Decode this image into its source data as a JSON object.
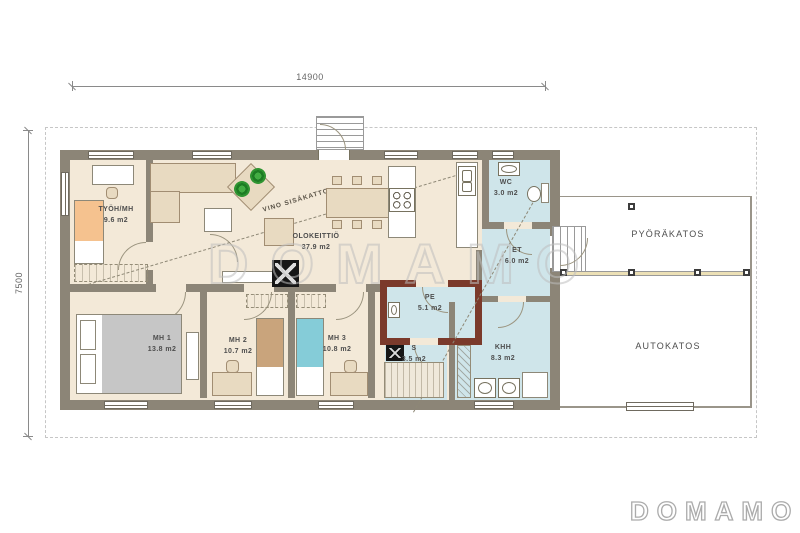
{
  "dimensions": {
    "width": "14900",
    "height": "7500"
  },
  "rooms": {
    "tyoh": {
      "name": "TYÖH/MH",
      "area": "9.6 m2"
    },
    "olokeittio": {
      "name": "OLOKEITTIÖ",
      "area": "37.9 m2"
    },
    "mh1": {
      "name": "MH 1",
      "area": "13.8 m2"
    },
    "mh2": {
      "name": "MH 2",
      "area": "10.7 m2"
    },
    "mh3": {
      "name": "MH 3",
      "area": "10.8 m2"
    },
    "wc": {
      "name": "WC",
      "area": "3.0 m2"
    },
    "et": {
      "name": "ET",
      "area": "6.0 m2"
    },
    "pe": {
      "name": "PE",
      "area": "5.1 m2"
    },
    "s": {
      "name": "S",
      "area": "3.5 m2"
    },
    "khh": {
      "name": "KHH",
      "area": "8.3 m2"
    }
  },
  "outdoor": {
    "bike_shelter": "PYÖRÄKATOS",
    "carport": "AUTOKATOS"
  },
  "annotations": {
    "sloped_ceiling": "VINO SISÄKATTO"
  },
  "branding": {
    "watermark": "DOMAMO",
    "logo": "DOMAMO"
  },
  "colors": {
    "wall": "#8c8577",
    "floor": "#f3e9d8",
    "wet_room": "#cfe5ea",
    "sauna_wall": "#7b3a2b",
    "wood_furniture": "#e8dac1"
  }
}
